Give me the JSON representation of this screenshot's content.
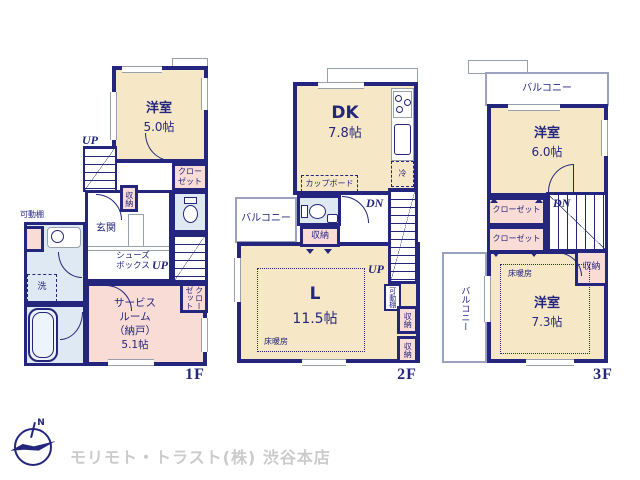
{
  "colors": {
    "wall_navy": "#24267d",
    "room_cream": "#f6e8c6",
    "room_pink": "#f9dcd6",
    "room_blue": "#dfe9f3",
    "balcony_outline": "#9aa2c0",
    "logo_text_gray": "#cbcbcb"
  },
  "labels": {
    "up": "UP",
    "dn": "DN",
    "closet": "クローゼット",
    "closet_two_line": "クロー\nゼット",
    "storage": "収納",
    "balcony": "バルコニー",
    "floor_heating": "床暖房",
    "movable_shelf": "可動棚"
  },
  "floor1": {
    "tag": "1F",
    "west_room": {
      "name": "洋室",
      "size": "5.0帖"
    },
    "entrance": "玄関",
    "shoe_box": "シューズ\nボックス",
    "service_room": "サービス\nルーム\n（納戸）\n5.1帖",
    "wash": "洗"
  },
  "floor2": {
    "tag": "2F",
    "dk": {
      "name": "DK",
      "size": "7.8帖"
    },
    "living": {
      "name": "L",
      "size": "11.5帖"
    },
    "cupboard": "カップボード",
    "fridge": "冷"
  },
  "floor3": {
    "tag": "3F",
    "room_upper": {
      "name": "洋室",
      "size": "6.0帖"
    },
    "room_lower": {
      "name": "洋室",
      "size": "7.3帖"
    }
  },
  "footer": {
    "logo_n": "N",
    "company": "モリモト・トラスト(株) 渋谷本店"
  }
}
